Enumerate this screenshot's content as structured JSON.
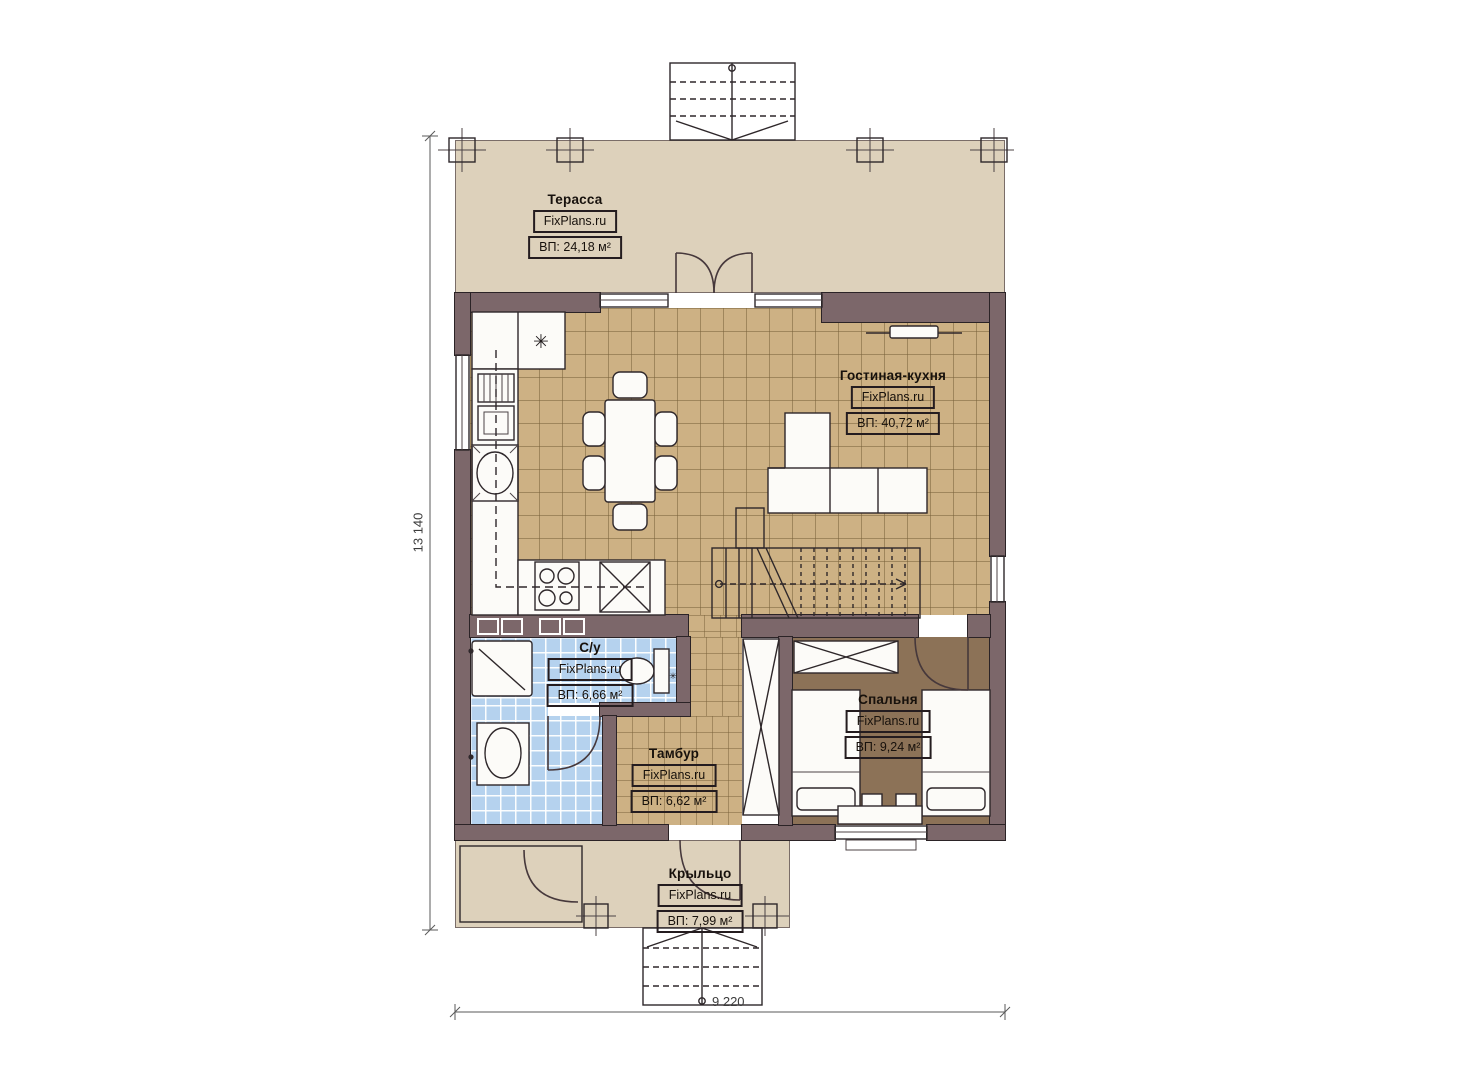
{
  "plan": {
    "type": "floor-plan",
    "brand": "FixPlans.ru",
    "rooms": [
      {
        "id": "terrace",
        "name": "Терасса",
        "brand": "FixPlans.ru",
        "area": "ВП: 24,18 м²"
      },
      {
        "id": "living_kitchen",
        "name": "Гостиная-кухня",
        "brand": "FixPlans.ru",
        "area": "ВП: 40,72 м²"
      },
      {
        "id": "bathroom",
        "name": "С/у",
        "brand": "FixPlans.ru",
        "area": "ВП: 6,66 м²"
      },
      {
        "id": "tambour",
        "name": "Тамбур",
        "brand": "FixPlans.ru",
        "area": "ВП: 6,62 м²"
      },
      {
        "id": "bedroom",
        "name": "Спальня",
        "brand": "FixPlans.ru",
        "area": "ВП: 9,24 м²"
      },
      {
        "id": "porch",
        "name": "Крыльцо",
        "brand": "FixPlans.ru",
        "area": "ВП: 7,99 м²"
      }
    ],
    "dimensions": {
      "vertical": "13 140",
      "horizontal": "9 220"
    },
    "icons": {
      "fridge": "✳",
      "toilet_valve": "✳"
    },
    "colors": {
      "wall": "#7c676a",
      "terrace_floor": "#ddd1bb",
      "living_tile": "#cdb184",
      "bath_tile": "#b5d2ee",
      "bedroom_floor": "#8c7257"
    }
  }
}
